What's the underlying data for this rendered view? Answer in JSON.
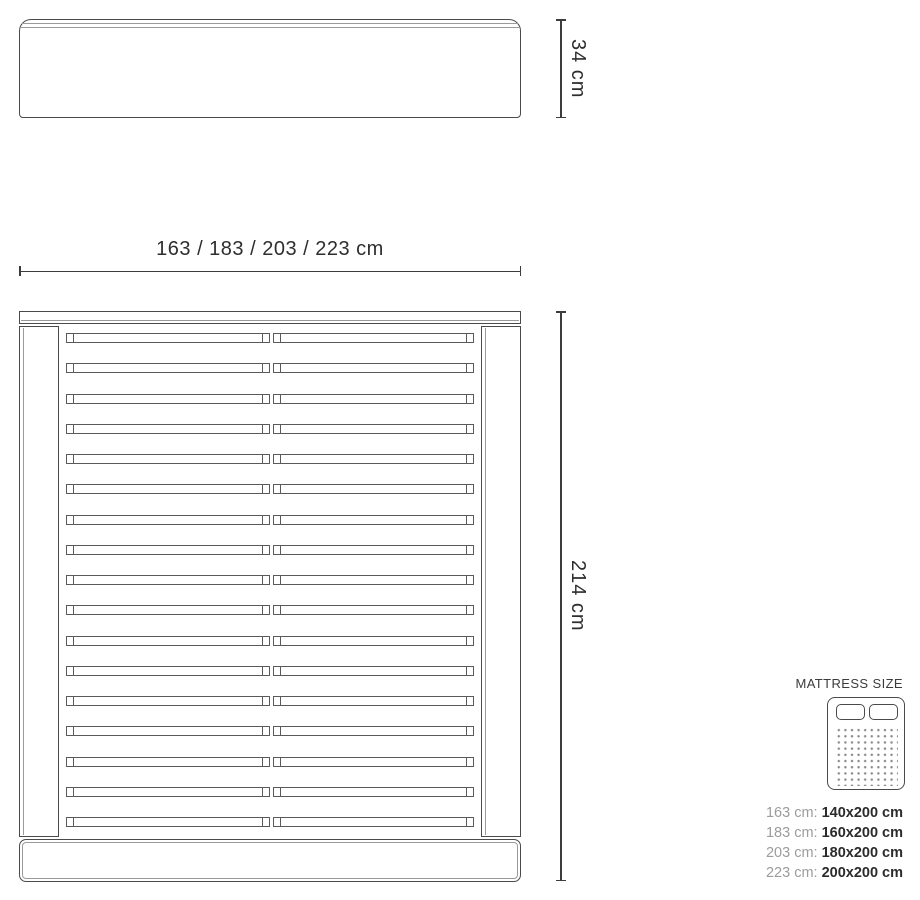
{
  "diagram": {
    "headboard": {
      "height_label": "34 cm"
    },
    "bed_frame": {
      "width_label": "163 / 183 / 203 / 223 cm",
      "length_label": "214 cm",
      "slat_count": 17
    }
  },
  "legend": {
    "title": "MATTRESS SIZE",
    "icon": "double-mattress-icon",
    "rows": [
      {
        "label": "163 cm:",
        "value": "140x200 cm"
      },
      {
        "label": "183 cm:",
        "value": "160x200 cm"
      },
      {
        "label": "203 cm:",
        "value": "180x200 cm"
      },
      {
        "label": "223 cm:",
        "value": "200x200 cm"
      }
    ]
  },
  "colors": {
    "outline": "#4a4a4a",
    "bevel": "#9a9a9a",
    "dimension_line": "#3c3c3c",
    "text_dark": "#2e2e2e",
    "text_muted": "#9c9c9c",
    "background": "#ffffff"
  }
}
